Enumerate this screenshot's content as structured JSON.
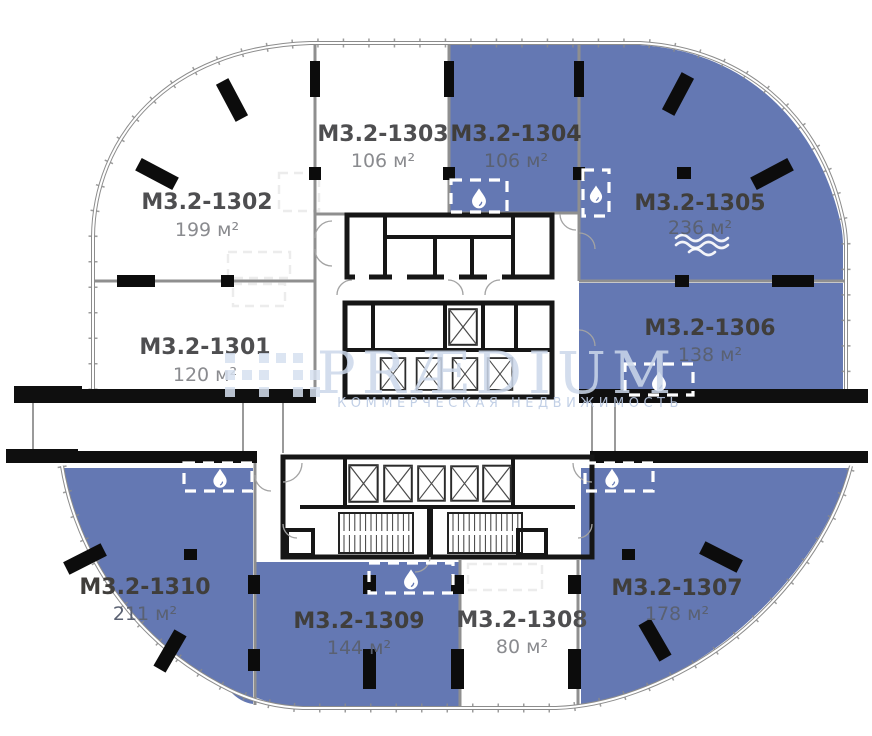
{
  "plan": {
    "units": [
      {
        "id": "М3.2-1301",
        "area": "120 м²",
        "highlighted": false
      },
      {
        "id": "М3.2-1302",
        "area": "199 м²",
        "highlighted": false
      },
      {
        "id": "М3.2-1303",
        "area": "106 м²",
        "highlighted": false
      },
      {
        "id": "М3.2-1304",
        "area": "106 м²",
        "highlighted": true
      },
      {
        "id": "М3.2-1305",
        "area": "236 м²",
        "highlighted": true,
        "water_feature_icon": true
      },
      {
        "id": "М3.2-1306",
        "area": "138 м²",
        "highlighted": true
      },
      {
        "id": "М3.2-1307",
        "area": "178 м²",
        "highlighted": true
      },
      {
        "id": "М3.2-1308",
        "area": "80 м²",
        "highlighted": false
      },
      {
        "id": "М3.2-1309",
        "area": "144 м²",
        "highlighted": true
      },
      {
        "id": "М3.2-1310",
        "area": "211 м²",
        "highlighted": true
      }
    ],
    "watermark": {
      "brand": "PRÆDIUM",
      "tagline": "КОММЕРЧЕСКАЯ НЕДВИЖИМОСТЬ"
    },
    "icons": {
      "wet_zone": "water-drop-icon",
      "water_feature": "waves-icon",
      "elevator": "elevator-shaft-icon",
      "stairs": "staircase-icon"
    },
    "colors": {
      "unit_highlight": "#6478b3",
      "wall": "#161616",
      "partition": "#8f8f8f",
      "unit_label": "#4e4e50",
      "area_text": "#8a8b8f",
      "watermark": "#ccd8eb"
    }
  }
}
